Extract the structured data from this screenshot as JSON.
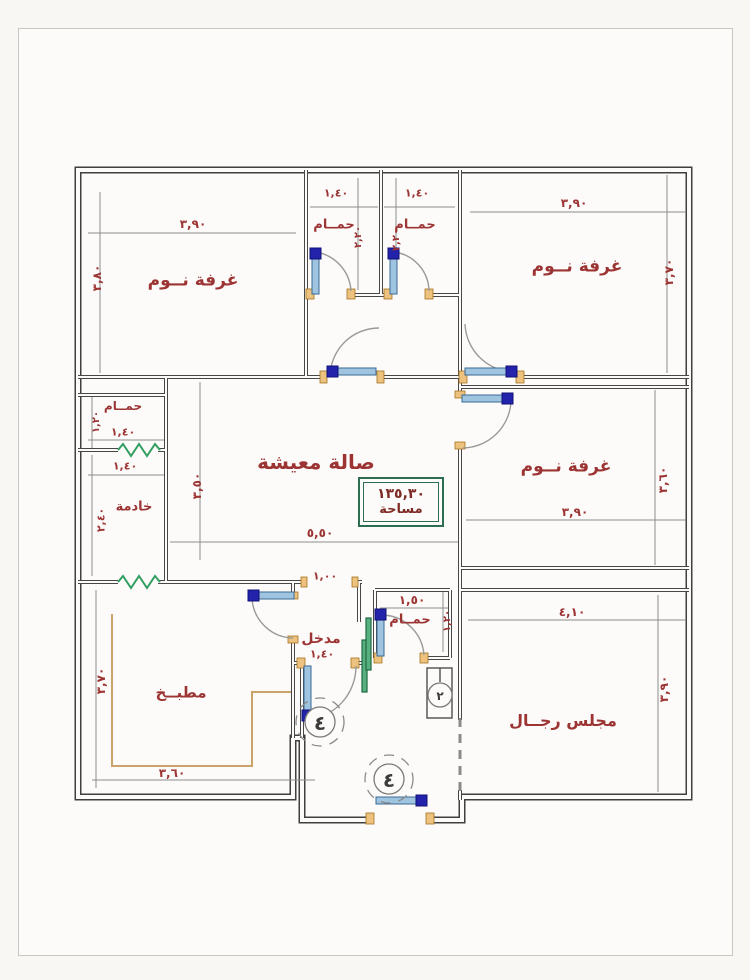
{
  "page": {
    "background": "#f8f7f4",
    "frame_border": "#c9c7c3"
  },
  "plan": {
    "area_badge": {
      "value": "١٣٥,٣٠",
      "label": "مساحة",
      "border_color": "#2d6e52",
      "text_color": "#7e2b26"
    },
    "rooms": [
      {
        "id": "bedroom-top-left",
        "text": "غرفة نــوم"
      },
      {
        "id": "bathroom-top-1",
        "text": "حمــام"
      },
      {
        "id": "bathroom-top-2",
        "text": "حمــام"
      },
      {
        "id": "bedroom-top-right",
        "text": "غرفة نــوم"
      },
      {
        "id": "bedroom-right",
        "text": "غرفة نــوم"
      },
      {
        "id": "living-room",
        "text": "صالة معيشة"
      },
      {
        "id": "maid-bathroom",
        "text": "حمــام"
      },
      {
        "id": "maid-room",
        "text": "خادمة"
      },
      {
        "id": "kitchen",
        "text": "مطبــخ"
      },
      {
        "id": "entrance",
        "text": "مدخل"
      },
      {
        "id": "bathroom-small",
        "text": "حمــام"
      },
      {
        "id": "majlis",
        "text": "مجلس رجــال"
      }
    ],
    "dimensions": [
      {
        "for": "bedroom-top-left-width",
        "text": "٣,٩٠"
      },
      {
        "for": "bedroom-top-left-height",
        "text": "٣,٨٠"
      },
      {
        "for": "bathroom-top-1-width",
        "text": "١,٤٠"
      },
      {
        "for": "bathroom-top-1-height",
        "text": "٢,٢٠"
      },
      {
        "for": "bathroom-top-2-width",
        "text": "١,٤٠"
      },
      {
        "for": "bathroom-top-2-height",
        "text": "٢,٢٠"
      },
      {
        "for": "bedroom-top-right-width",
        "text": "٣,٩٠"
      },
      {
        "for": "bedroom-top-right-height",
        "text": "٣,٧٠"
      },
      {
        "for": "living-room-height",
        "text": "٣,٥٠"
      },
      {
        "for": "living-room-width",
        "text": "٥,٥٠"
      },
      {
        "for": "living-opening-width",
        "text": "١,٠٠"
      },
      {
        "for": "maid-bathroom-height",
        "text": "١,٢٠"
      },
      {
        "for": "maid-bathroom-width",
        "text": "١,٤٠"
      },
      {
        "for": "maid-room-width",
        "text": "١,٤٠"
      },
      {
        "for": "maid-room-height",
        "text": "٢,٤٠"
      },
      {
        "for": "bedroom-right-width",
        "text": "٣,٩٠"
      },
      {
        "for": "bedroom-right-height",
        "text": "٣,٦٠"
      },
      {
        "for": "kitchen-height",
        "text": "٣,٧٠"
      },
      {
        "for": "kitchen-width",
        "text": "٣,٦٠"
      },
      {
        "for": "entrance-width",
        "text": "١,٤٠"
      },
      {
        "for": "bathroom-small-width",
        "text": "١,٥٠"
      },
      {
        "for": "bathroom-small-height",
        "text": "١,٢٠"
      },
      {
        "for": "majlis-width",
        "text": "٤,١٠"
      },
      {
        "for": "majlis-height",
        "text": "٣,٩٠"
      }
    ],
    "symbols": {
      "fan_number": "٤",
      "shaft_number": "٢"
    },
    "colors": {
      "wall": "#3f3f3f",
      "dimension_text": "#9c3434",
      "door_leaf": "#9fc4e0",
      "door_cap": "#2222aa",
      "jamb": "#ecc27e",
      "window": "#2f9e5f",
      "dim_line": "#8d8d8d",
      "area_border": "#2d6e52"
    }
  }
}
